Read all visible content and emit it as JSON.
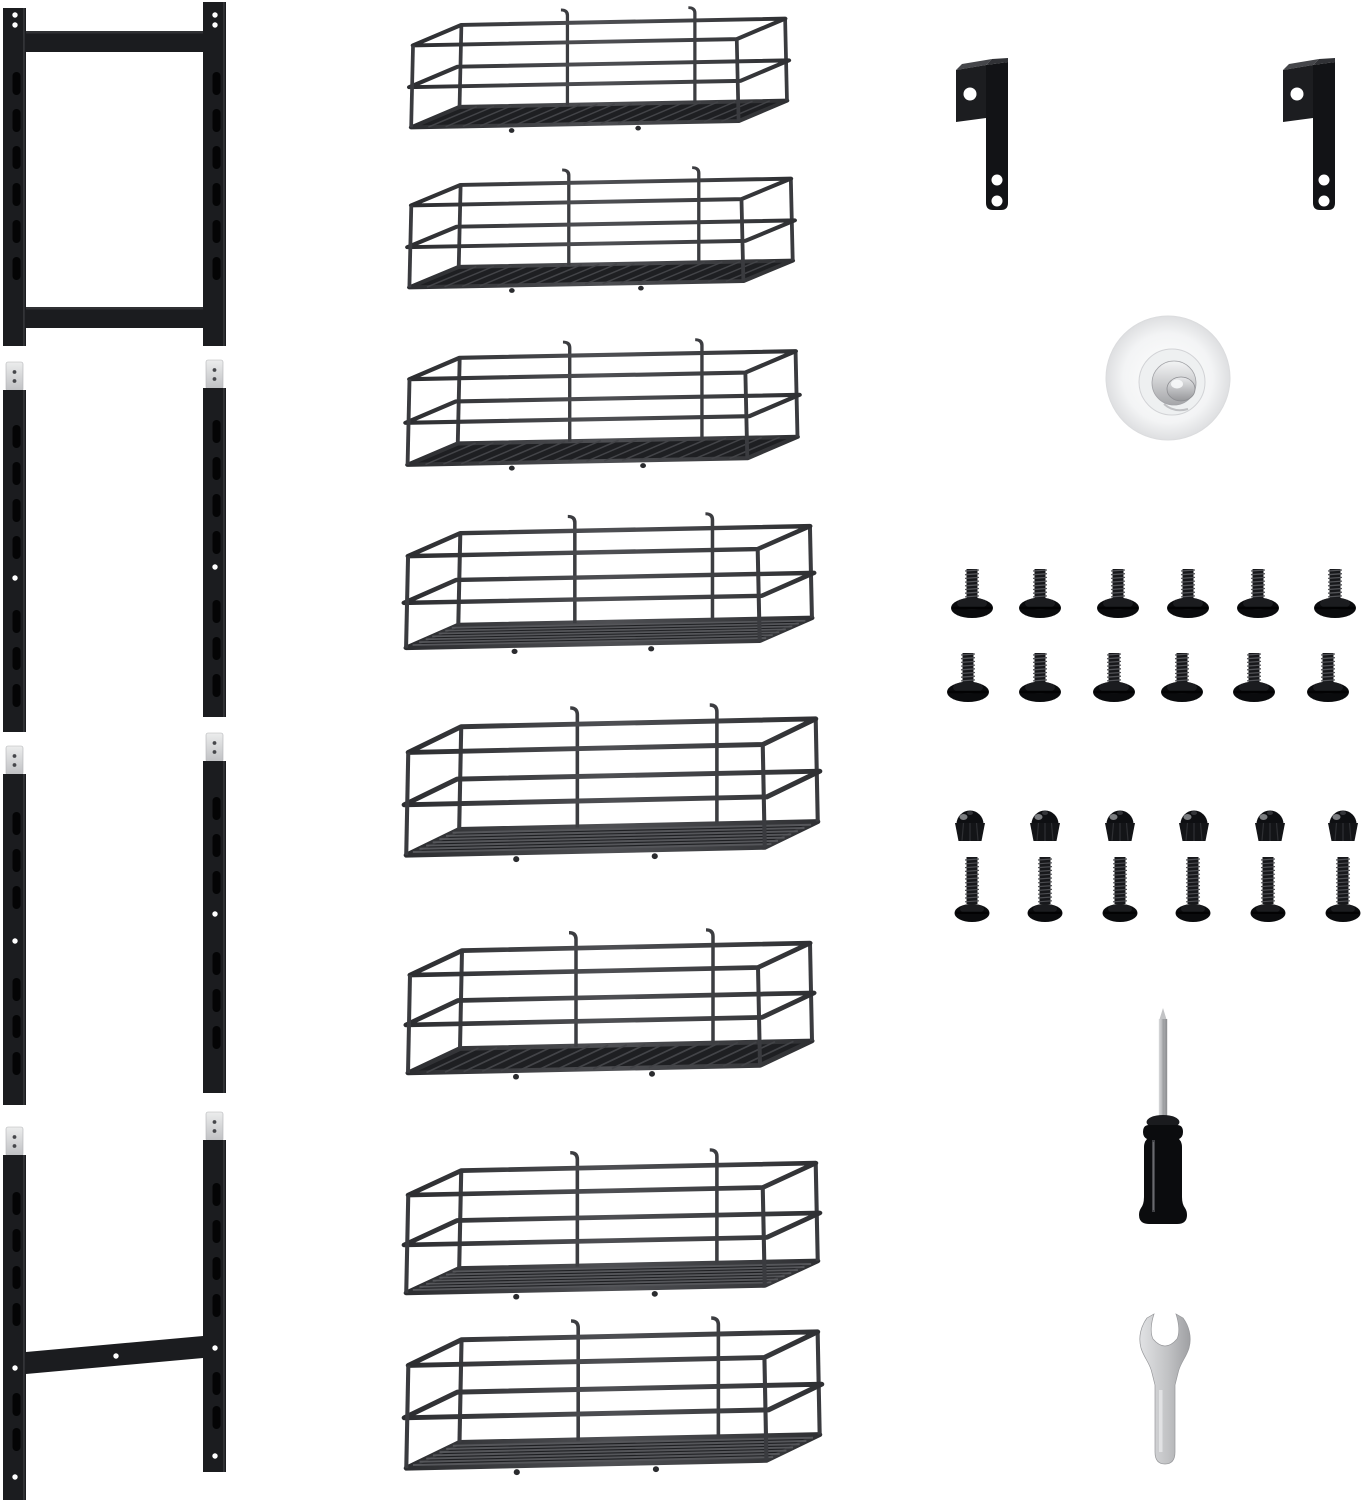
{
  "photo": {
    "type": "wall-rack-organizer-parts-kit",
    "background": "#ffffff",
    "colors": {
      "frame_black": "#1b1c1f",
      "wire_charcoal": "#3a3b3e",
      "connector_silver": "#d7d8da",
      "hardware_black": "#0f1013",
      "tool_chrome": "#c3c4c7",
      "suction_white": "#f4f5f6"
    },
    "parts": {
      "top_frame": {
        "name": "slotted-top-mount-frame",
        "count": 1
      },
      "rail_segments": {
        "name": "slotted-extension-rail",
        "count": 4
      },
      "bottom_frame": {
        "name": "slotted-bottom-frame-with-crossbar",
        "count": 1
      },
      "baskets": {
        "name": "wire-basket-shelf",
        "count": 8
      },
      "brackets": {
        "name": "l-shaped-mounting-bracket",
        "count": 2
      },
      "suction_pad": {
        "name": "round-adhesive-wall-anchor",
        "count": 1
      },
      "short_screws": {
        "name": "short-round-head-screw",
        "count": 12
      },
      "cap_nuts": {
        "name": "dome-cap-nut",
        "count": 6
      },
      "long_bolts": {
        "name": "long-round-head-bolt",
        "count": 6
      },
      "screwdriver": {
        "name": "screwdriver",
        "count": 1
      },
      "wrench": {
        "name": "open-end-wrench",
        "count": 1
      }
    }
  }
}
